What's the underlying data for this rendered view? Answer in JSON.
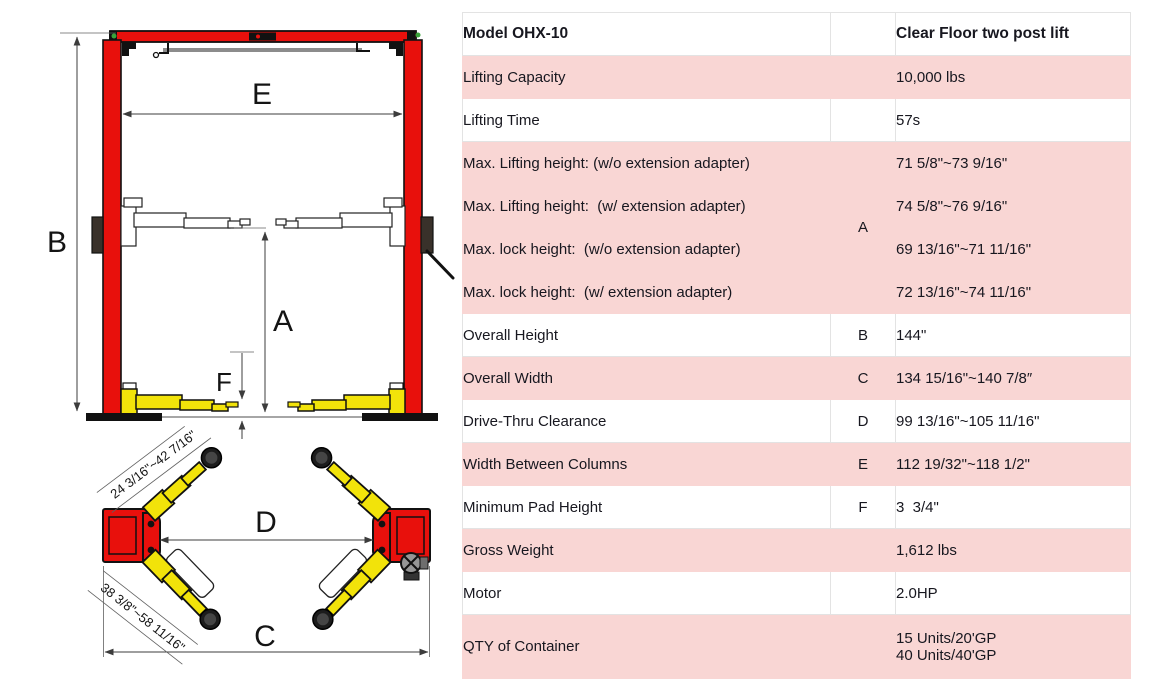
{
  "table": {
    "header": {
      "model": "Model OHX-10",
      "letter": "",
      "type": "Clear Floor two post lift"
    },
    "rows": [
      {
        "label": "Lifting Capacity",
        "letter": "",
        "value": "10,000 lbs",
        "pink": true
      },
      {
        "label": "Lifting Time",
        "letter": "",
        "value": "57s",
        "pink": false
      },
      {
        "label": "Max. Lifting height: (w/o extension adapter)",
        "letter": "A",
        "letterRowspan": 4,
        "value": "71 5/8\"~73 9/16\"",
        "pink": true
      },
      {
        "label": "Max. Lifting height:  (w/ extension adapter)",
        "letter": null,
        "value": "74 5/8\"~76 9/16\"",
        "pink": true
      },
      {
        "label": "Max. lock height:  (w/o extension adapter)",
        "letter": null,
        "value": "69 13/16\"~71 11/16\"",
        "pink": true
      },
      {
        "label": "Max. lock height:  (w/ extension adapter)",
        "letter": null,
        "value": "72 13/16\"~74 11/16\"",
        "pink": true
      },
      {
        "label": "Overall Height",
        "letter": "B",
        "value": "144\"",
        "pink": false
      },
      {
        "label": "Overall Width",
        "letter": "C",
        "value": "134 15/16\"~140 7/8″",
        "pink": true
      },
      {
        "label": "Drive-Thru Clearance",
        "letter": "D",
        "value": "99 13/16\"~105 11/16\"",
        "pink": false
      },
      {
        "label": "Width Between Columns",
        "letter": "E",
        "value": "112 19/32\"~118 1/2\"",
        "pink": true
      },
      {
        "label": "Minimum Pad Height",
        "letter": "F",
        "value": "3  3/4\"",
        "pink": false
      },
      {
        "label": "Gross Weight",
        "letter": "",
        "value": "1,612 lbs",
        "pink": true
      },
      {
        "label": "Motor",
        "letter": "",
        "value": "2.0HP",
        "pink": false
      },
      {
        "label": "QTY of Container",
        "letter": "",
        "value": "15 Units/20'GP\n40 Units/40'GP",
        "pink": true,
        "tall": true
      }
    ]
  },
  "diagram": {
    "front_view_labels": {
      "B": "B",
      "E": "E",
      "A": "A",
      "F": "F"
    },
    "top_view_labels": {
      "D": "D",
      "C": "C"
    },
    "front_arm_reach_label": "24 3/16\"~42 7/16\"",
    "rear_arm_reach_label": "38 3/8\"~58 11/16\"",
    "colors": {
      "column_red": "#e8100c",
      "arm_yellow": "#f2e30a",
      "table_row_pink": "#f9d6d4"
    }
  }
}
